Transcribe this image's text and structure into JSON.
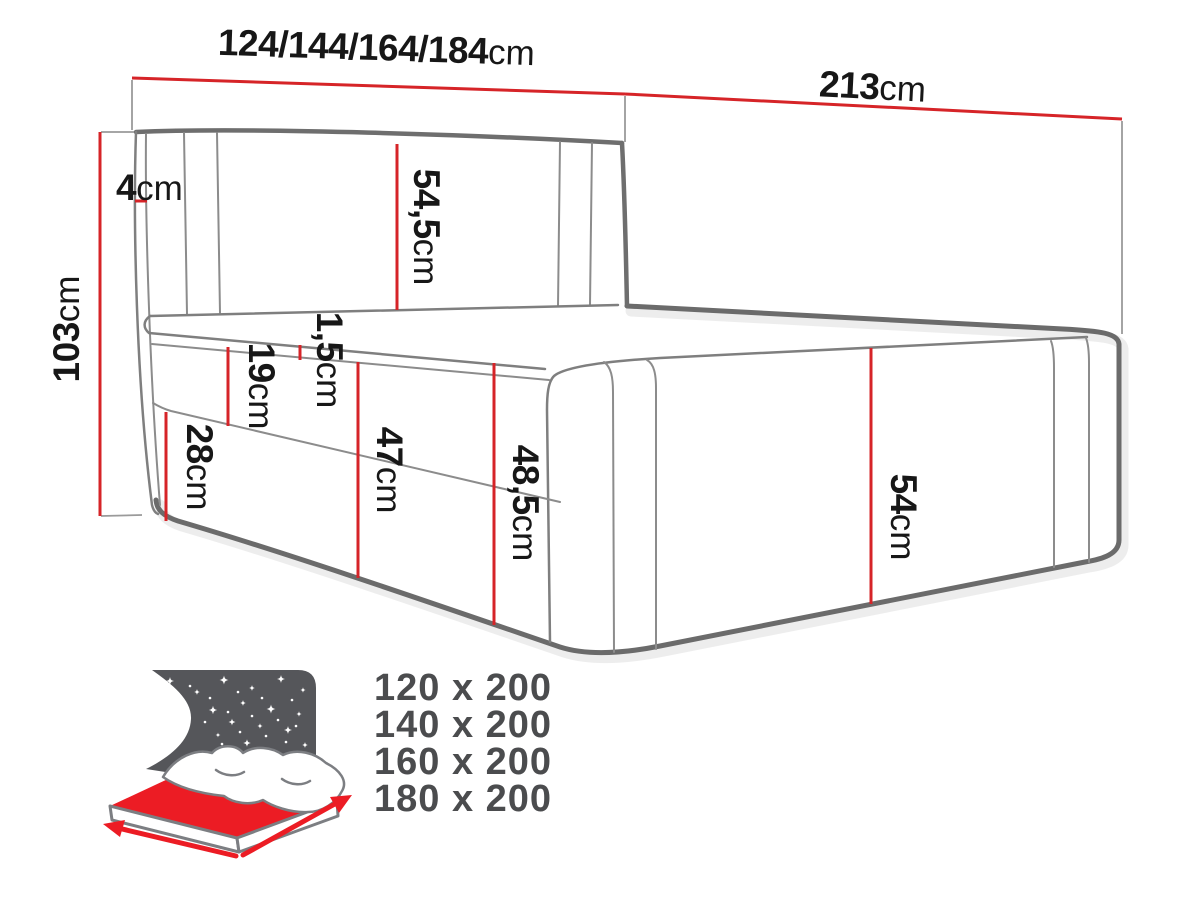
{
  "dims": {
    "width": {
      "value": "124/144/164/184",
      "unit": "cm"
    },
    "depth": {
      "value": "213",
      "unit": "cm"
    },
    "height": {
      "value": "103",
      "unit": "cm"
    },
    "d4": {
      "value": "4",
      "unit": "cm"
    },
    "d54_5": {
      "value": "54,5",
      "unit": "cm"
    },
    "d1_5": {
      "value": "1,5",
      "unit": "cm"
    },
    "d19": {
      "value": "19",
      "unit": "cm"
    },
    "d28": {
      "value": "28",
      "unit": "cm"
    },
    "d47": {
      "value": "47",
      "unit": "cm"
    },
    "d48_5": {
      "value": "48,5",
      "unit": "cm"
    },
    "d54": {
      "value": "54",
      "unit": "cm"
    }
  },
  "size_variants": [
    "120 x 200",
    "140 x 200",
    "160 x 200",
    "180 x 200"
  ],
  "icon": {
    "name": "storage-bed-icon"
  },
  "colors": {
    "dimension_red": "#d62428",
    "icon_red": "#ec1c24",
    "line_gray": "#8c8c8c",
    "line_gray_dark": "#6e6e6e",
    "text_black": "#171717",
    "icon_gray": "#55565a",
    "sizes_text_gray": "#4b4c4e"
  }
}
